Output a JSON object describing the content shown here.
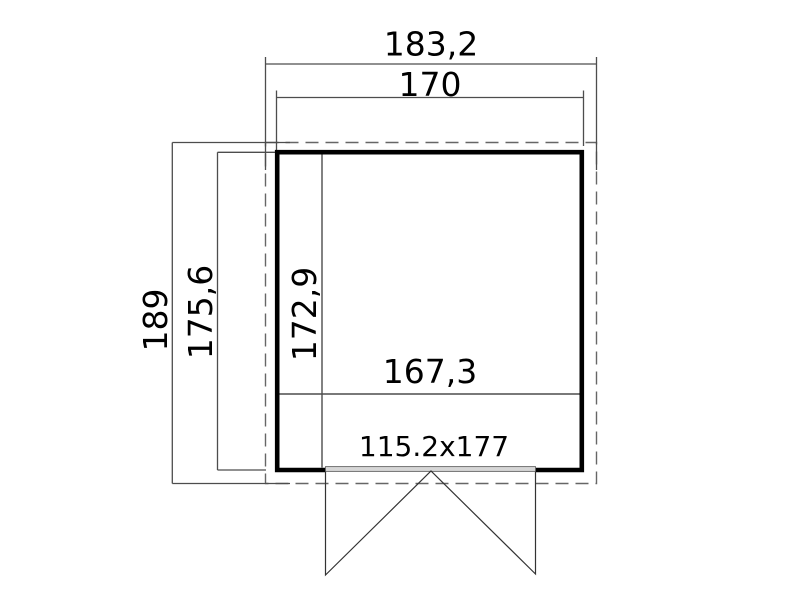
{
  "labels": {
    "overall_width": "183,2",
    "wall_outer_width": "170",
    "overall_depth": "189",
    "wall_outer_depth": "175,6",
    "interior_depth": "172,9",
    "interior_width": "167,3",
    "door_size": "115.2x177"
  },
  "colors": {
    "wall_line": "#000000",
    "dimension_line": "#4d4d4d",
    "dashed_outline": "#666666",
    "door_line": "#333333",
    "threshold_fill": "#d6d6d6",
    "label_text": "#000000",
    "background": "#ffffff"
  }
}
